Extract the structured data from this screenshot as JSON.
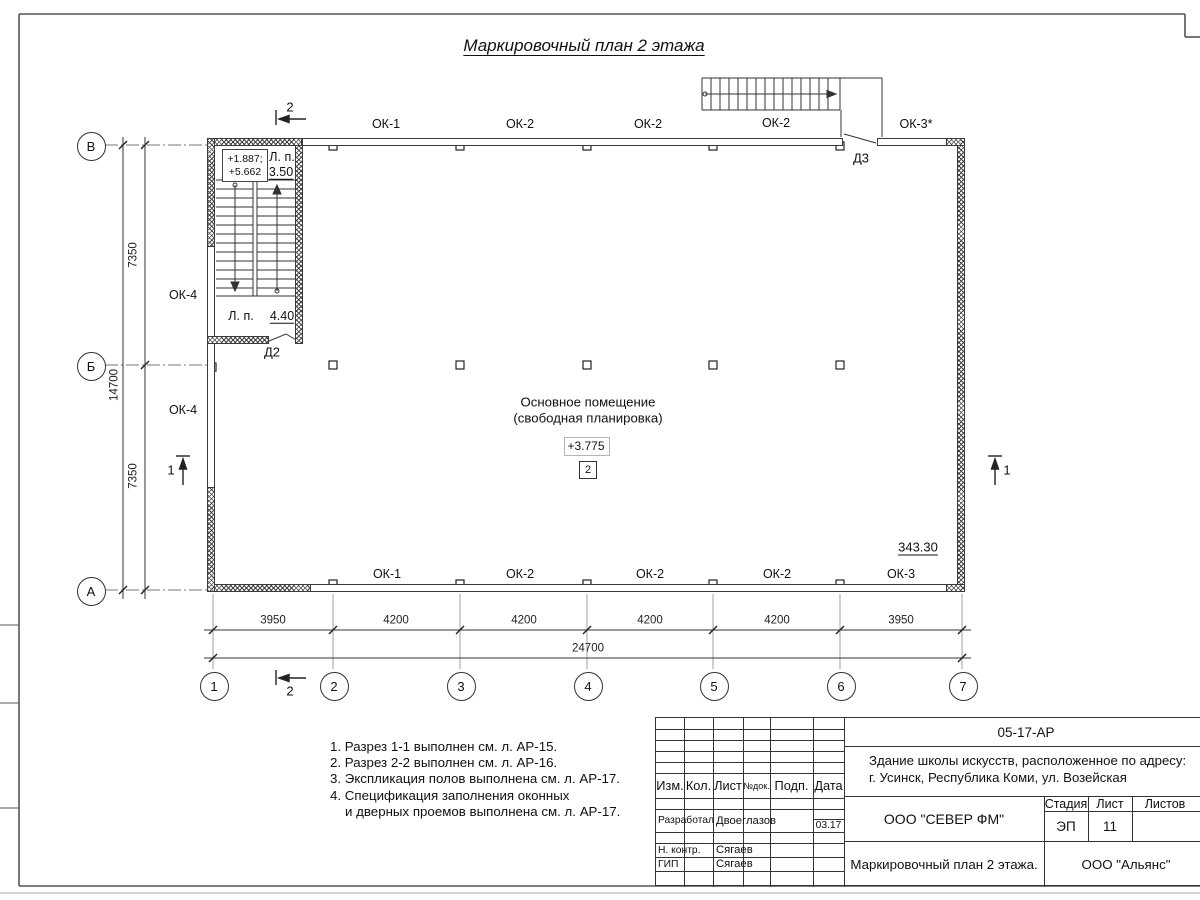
{
  "title": "Маркировочный план 2 этажа",
  "plan": {
    "room": {
      "name_line1": "Основное помещение",
      "name_line2": "(свободная планировка)",
      "elevation": "+3.775",
      "zone": "2",
      "area": "343.30"
    },
    "stair": {
      "levels_line1": "+1.887;",
      "levels_line2": "+5.662",
      "lp_top_label": "Л. п.",
      "lp_top_value": "3.50",
      "lp_bottom_label": "Л. п.",
      "lp_bottom_value": "4.40"
    },
    "doors": {
      "d2": "Д2",
      "d3": "Д3"
    },
    "windows_top": [
      "ОК-1",
      "ОК-2",
      "ОК-2",
      "ОК-2",
      "ОК-3*"
    ],
    "windows_bottom": [
      "ОК-1",
      "ОК-2",
      "ОК-2",
      "ОК-2",
      "ОК-3"
    ],
    "windows_left": [
      "ОК-4",
      "ОК-4"
    ],
    "axes_horizontal": [
      "1",
      "2",
      "3",
      "4",
      "5",
      "6",
      "7"
    ],
    "axes_vertical": [
      "В",
      "Б",
      "А"
    ],
    "dims_bottom": [
      "3950",
      "4200",
      "4200",
      "4200",
      "4200",
      "3950"
    ],
    "dim_bottom_total": "24700",
    "dims_left": [
      "7350",
      "7350"
    ],
    "dim_left_total": "14700",
    "section_mark_1": "1",
    "section_mark_2": "2"
  },
  "notes": [
    "1. Разрез 1-1 выполнен см. л. АР-15.",
    "2. Разрез 2-2 выполнен см. л. АР-16.",
    "3. Экспликация полов выполнена см. л. АР-17.",
    "4. Спецификация заполнения оконных",
    "и дверных проемов выполнена см. л. АР-17."
  ],
  "titleblock": {
    "doc_code": "05-17-АР",
    "project_line1": "Здание школы искусств, расположенное по адресу:",
    "project_line2": "г. Усинск, Республика Коми, ул. Возейская",
    "header_cols": [
      "Изм.",
      "Кол.",
      "Лист",
      "№док.",
      "Подп.",
      "Дата"
    ],
    "row_dev_role": "Разработал",
    "row_dev_name": "Двоеглазов",
    "row_dev_date": "03.17",
    "row_nk_role": "Н. контр.",
    "row_nk_name": "Сягаев",
    "row_gip_role": "ГИП",
    "row_gip_name": "Сягаев",
    "company": "ООО \"СЕВЕР ФМ\"",
    "stage_label": "Стадия",
    "stage_value": "ЭП",
    "sheet_label": "Лист",
    "sheet_value": "11",
    "sheets_label": "Листов",
    "sheet_title": "Маркировочный план 2 этажа.",
    "contractor": "ООО \"Альянс\""
  }
}
